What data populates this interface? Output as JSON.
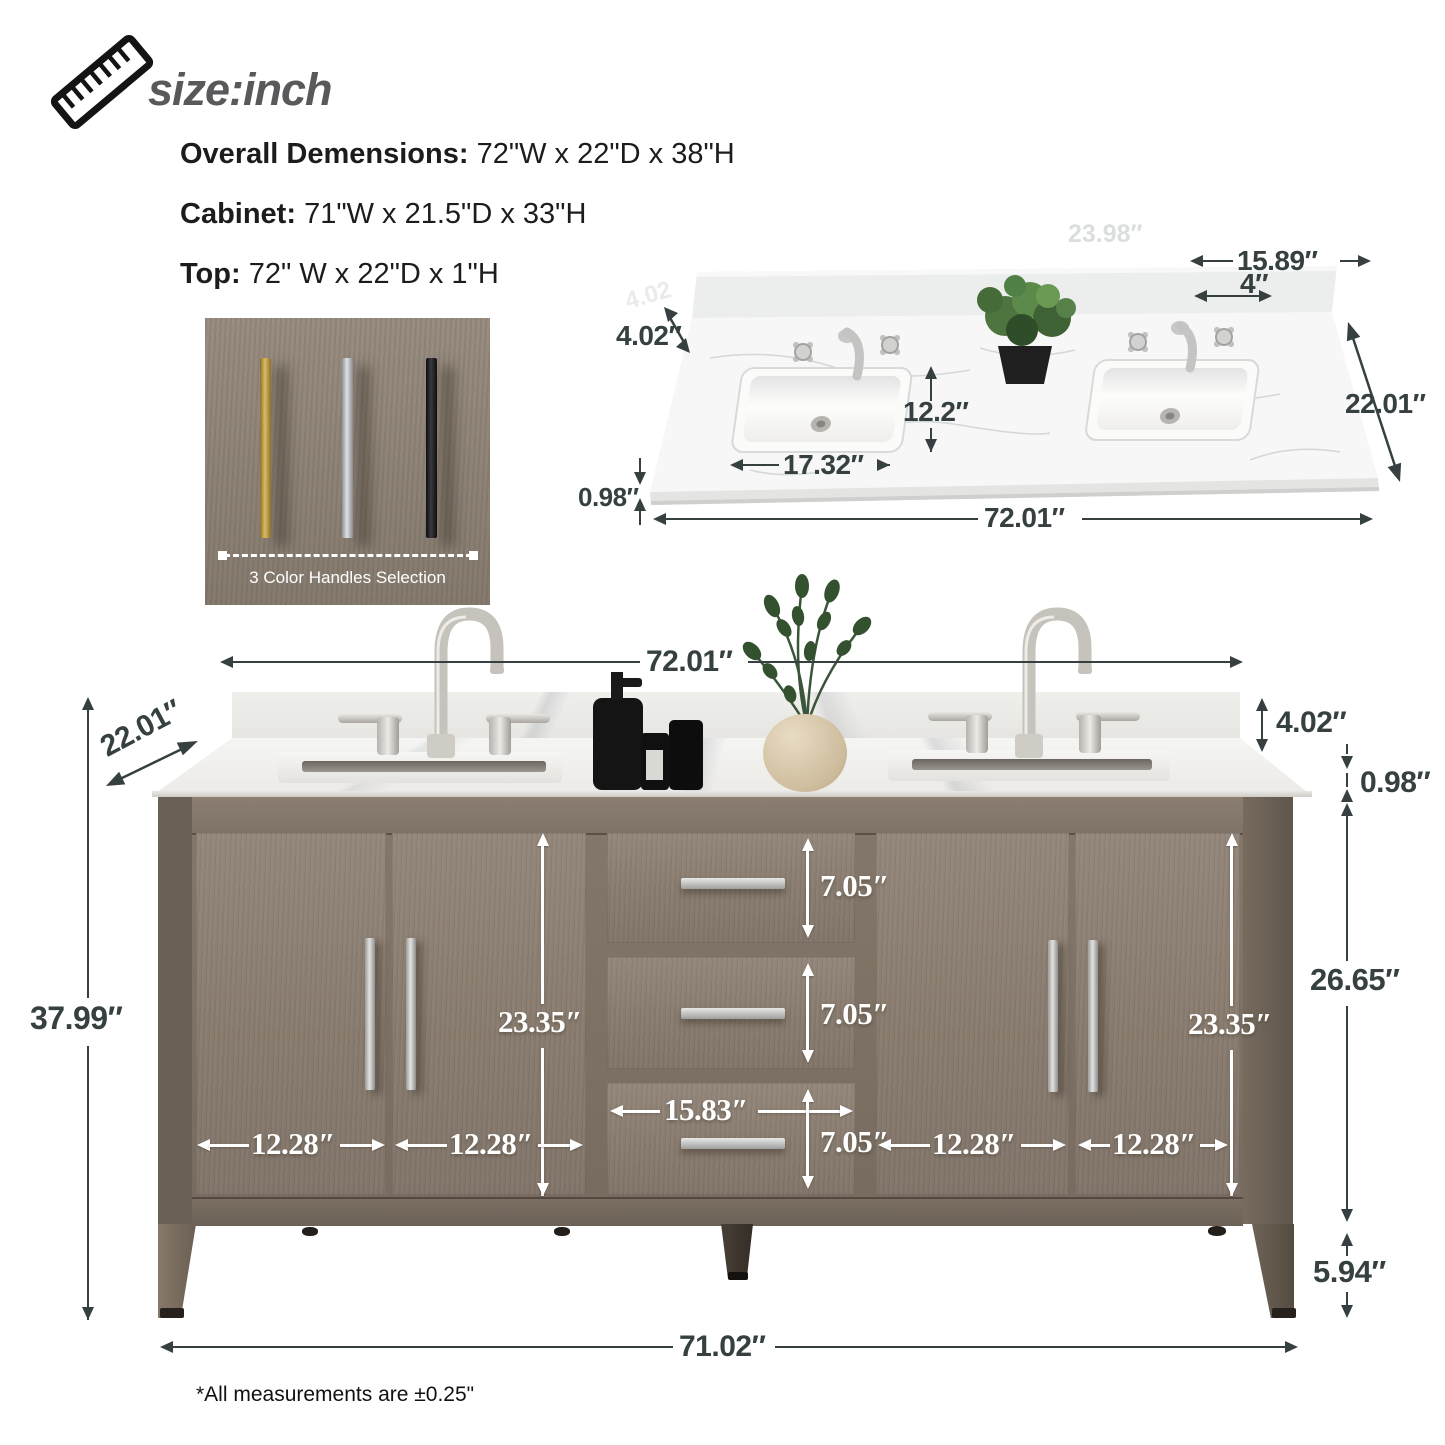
{
  "header": {
    "size_label": "size:inch",
    "specs": [
      {
        "label": "Overall Demensions:",
        "value": "72\"W x 22\"D x 38\"H"
      },
      {
        "label": "Cabinet:",
        "value": "71\"W x 21.5\"D x 33\"H"
      },
      {
        "label": "Top:",
        "value": "72\" W x 22\"D x 1\"H"
      }
    ]
  },
  "handle_box": {
    "caption": "3 Color Handles Selection",
    "handle_colors": [
      "gold",
      "silver",
      "black"
    ],
    "gold_hex": "#b7984d",
    "silver_hex": "#c0c3c6",
    "black_hex": "#1e1e20"
  },
  "countertop": {
    "backsplash_h": "4.02″",
    "faucet_spread": "15.89″",
    "hole_spacing": "4″",
    "depth": "22.01″",
    "sink_depth": "12.2″",
    "sink_width": "17.32″",
    "edge_thickness": "0.98″",
    "width": "72.01″",
    "watermark_a": "4.02",
    "watermark_b": "23.98″"
  },
  "vanity": {
    "width": "72.01″",
    "depth": "22.01″",
    "height": "37.99″",
    "backsplash_h": "4.02″",
    "top_thickness": "0.98″",
    "body_height": "26.65″",
    "leg_height": "5.94″",
    "base_width": "71.02″",
    "door_height": "23.35″",
    "door_width": "12.28″",
    "drawer_height": "7.05″",
    "drawer_width": "15.83″"
  },
  "footnote": "*All measurements are ±0.25\"",
  "accent_colors": {
    "dimension_dark": "#364040",
    "dimension_light": "#ffffff",
    "wood": "#887b6e"
  }
}
